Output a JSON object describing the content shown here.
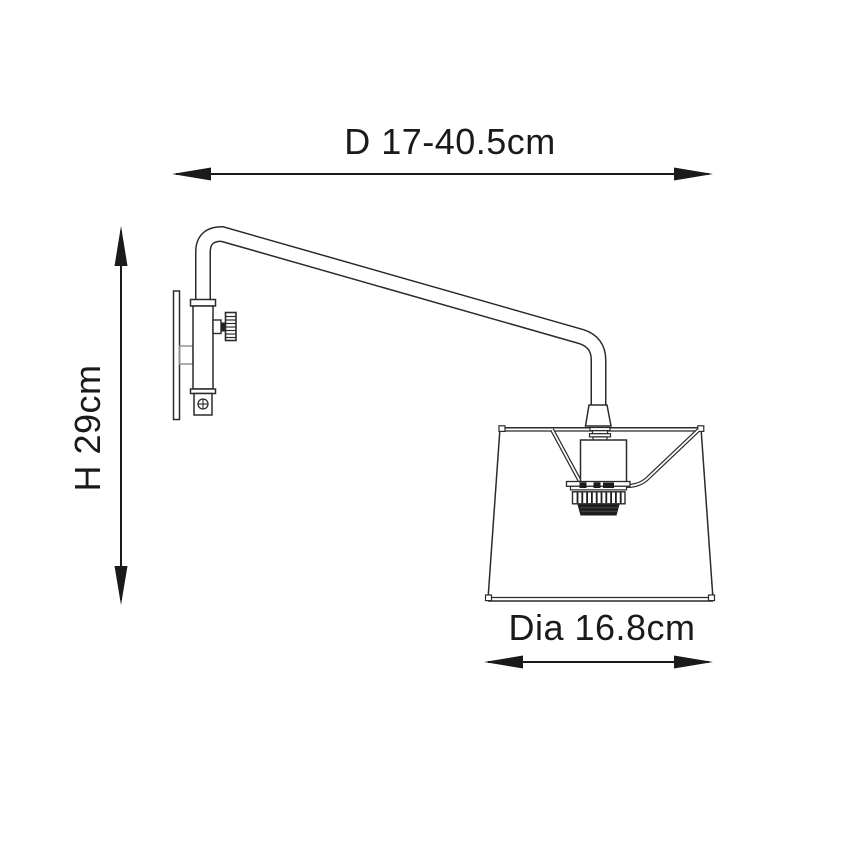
{
  "page": {
    "background": "#ffffff",
    "line_color": "#2b2b2b",
    "accent_gray": "#8a8a8a",
    "text_color": "#1a1a1a"
  },
  "diagram": {
    "type": "technical-line-drawing",
    "subject": "swing-arm wall light, side elevation",
    "dimensions": {
      "depth": {
        "label": "D 17-40.5cm",
        "orientation": "horizontal",
        "position": "top"
      },
      "height": {
        "label": "H 29cm",
        "orientation": "vertical",
        "position": "left"
      },
      "diameter": {
        "label": "Dia 16.8cm",
        "orientation": "horizontal",
        "position": "bottom"
      }
    }
  }
}
